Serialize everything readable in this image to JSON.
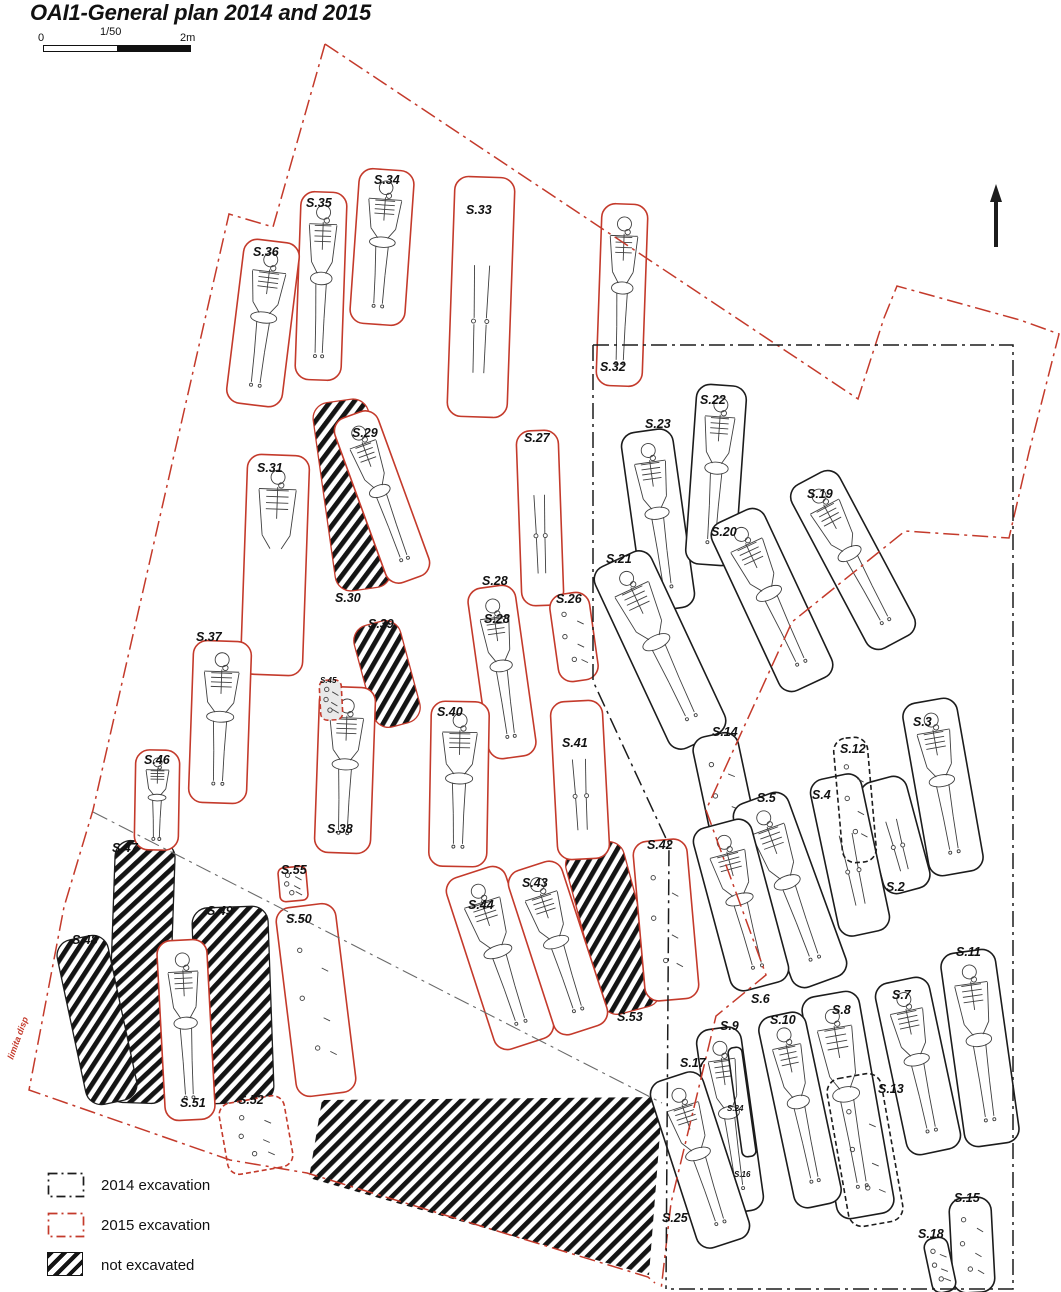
{
  "title": "OAI1-General plan 2014 and 2015",
  "scale_bar": {
    "left_label": "0",
    "mid_label": "1/50",
    "right_label": "2m"
  },
  "north_arrow": {
    "x": 996,
    "y_top": 184,
    "y_bottom": 247
  },
  "boundary_note": {
    "text": "limita disp",
    "x": 13,
    "y": 1060,
    "angle": -70
  },
  "colors": {
    "red": "#c43a2b",
    "black": "#1c1c1c",
    "gray": "#6a6a6a",
    "bone": "#3f3f3f",
    "label": "#111111"
  },
  "legend": [
    {
      "key": "excavation-2014",
      "label": "2014 excavation",
      "style": "dashdot",
      "color": "#1c1c1c"
    },
    {
      "key": "excavation-2015",
      "label": "2015 excavation",
      "style": "dashdot",
      "color": "#c43a2b"
    },
    {
      "key": "not-excavated",
      "label": "not excavated",
      "style": "hatch",
      "color": "#141414"
    }
  ],
  "hatched_areas": [
    {
      "id": "s30",
      "label": "S.30",
      "type": "rect",
      "x": 352,
      "y": 495,
      "w": 56,
      "h": 190,
      "a": -8,
      "outline": "red",
      "lx": 335,
      "ly": 591
    },
    {
      "id": "s39",
      "label": "S.39",
      "type": "rect",
      "x": 387,
      "y": 674,
      "w": 48,
      "h": 105,
      "a": -15,
      "outline": "red",
      "lx": 368,
      "ly": 617
    },
    {
      "id": "s47",
      "label": "S.47",
      "type": "rect",
      "x": 141,
      "y": 972,
      "w": 60,
      "h": 262,
      "a": 2,
      "outline": "black",
      "lx": 112,
      "ly": 841
    },
    {
      "id": "s48",
      "label": "S.48",
      "type": "rect",
      "x": 97,
      "y": 1020,
      "w": 52,
      "h": 168,
      "a": -12,
      "outline": "black",
      "lx": 72,
      "ly": 933
    },
    {
      "id": "s49",
      "label": "S.49",
      "type": "rect",
      "x": 233,
      "y": 1005,
      "w": 76,
      "h": 196,
      "a": -2,
      "outline": "black",
      "lx": 207,
      "ly": 904
    },
    {
      "id": "s53",
      "label": "S.53",
      "type": "rect",
      "x": 613,
      "y": 928,
      "w": 60,
      "h": 170,
      "a": -15,
      "outline": "red",
      "lx": 617,
      "ly": 1010
    },
    {
      "id": "south-area",
      "label": "",
      "type": "poly",
      "pts": [
        [
          322,
          1100
        ],
        [
          658,
          1097
        ],
        [
          661,
          1120
        ],
        [
          649,
          1275
        ],
        [
          309,
          1178
        ]
      ],
      "outline": "none",
      "lx": 0,
      "ly": 0
    }
  ],
  "graves": [
    {
      "id": "s33",
      "label": "S.33",
      "x": 481,
      "y": 297,
      "w": 60,
      "h": 240,
      "a": 2,
      "year": "2015",
      "content": "legs",
      "lx": 466,
      "ly": 203
    },
    {
      "id": "s34",
      "label": "S.34",
      "x": 382,
      "y": 247,
      "w": 55,
      "h": 155,
      "a": 4,
      "year": "2015",
      "content": "full",
      "lx": 374,
      "ly": 173
    },
    {
      "id": "s35",
      "label": "S.35",
      "x": 321,
      "y": 286,
      "w": 46,
      "h": 188,
      "a": 2,
      "year": "2015",
      "content": "full",
      "lx": 306,
      "ly": 196
    },
    {
      "id": "s36",
      "label": "S.36",
      "x": 263,
      "y": 323,
      "w": 56,
      "h": 165,
      "a": 7,
      "year": "2015",
      "content": "full",
      "lx": 253,
      "ly": 245
    },
    {
      "id": "s32",
      "label": "S.32",
      "x": 622,
      "y": 295,
      "w": 46,
      "h": 182,
      "a": 2,
      "year": "2015",
      "content": "full",
      "lx": 600,
      "ly": 360
    },
    {
      "id": "s31",
      "label": "S.31",
      "x": 275,
      "y": 565,
      "w": 62,
      "h": 220,
      "a": 2,
      "year": "2015",
      "content": "torso",
      "lx": 257,
      "ly": 461
    },
    {
      "id": "s29",
      "label": "S.29",
      "x": 382,
      "y": 497,
      "w": 46,
      "h": 175,
      "a": -20,
      "year": "2015",
      "content": "full",
      "lx": 352,
      "ly": 426
    },
    {
      "id": "s27",
      "label": "S.27",
      "x": 540,
      "y": 518,
      "w": 42,
      "h": 175,
      "a": -2,
      "year": "2015",
      "content": "legs",
      "lx": 524,
      "ly": 431
    },
    {
      "id": "s28",
      "label": "S.28",
      "x": 502,
      "y": 672,
      "w": 48,
      "h": 172,
      "a": -8,
      "year": "2015",
      "content": "full",
      "lx": 482,
      "ly": 574
    },
    {
      "id": "s26",
      "label": "S.26",
      "x": 574,
      "y": 637,
      "w": 40,
      "h": 88,
      "a": -8,
      "year": "2015",
      "content": "scatter",
      "lx": 556,
      "ly": 592
    },
    {
      "id": "s37",
      "label": "S.37",
      "x": 220,
      "y": 722,
      "w": 58,
      "h": 162,
      "a": 2,
      "year": "2015",
      "content": "full",
      "lx": 196,
      "ly": 630
    },
    {
      "id": "s38",
      "label": "S.38",
      "x": 345,
      "y": 770,
      "w": 56,
      "h": 166,
      "a": 2,
      "year": "2015",
      "content": "full",
      "lx": 327,
      "ly": 822
    },
    {
      "id": "s45",
      "label": "S.45",
      "x": 331,
      "y": 700,
      "w": 22,
      "h": 40,
      "a": -3,
      "year": "2015",
      "content": "scatter",
      "lx": 320,
      "ly": 676,
      "small": true,
      "dash": true,
      "fill": "#e9e9e9"
    },
    {
      "id": "s40",
      "label": "S.40",
      "x": 459,
      "y": 784,
      "w": 58,
      "h": 165,
      "a": 1,
      "year": "2015",
      "content": "full",
      "lx": 437,
      "ly": 705
    },
    {
      "id": "s41",
      "label": "S.41",
      "x": 580,
      "y": 780,
      "w": 52,
      "h": 158,
      "a": -3,
      "year": "2015",
      "content": "legs",
      "lx": 562,
      "ly": 736
    },
    {
      "id": "s46",
      "label": "S.46",
      "x": 157,
      "y": 800,
      "w": 44,
      "h": 100,
      "a": 1,
      "year": "2015",
      "content": "full",
      "lx": 144,
      "ly": 753
    },
    {
      "id": "s50",
      "label": "S.50",
      "x": 316,
      "y": 1000,
      "w": 60,
      "h": 190,
      "a": -7,
      "year": "2015",
      "content": "scatter",
      "lx": 286,
      "ly": 912
    },
    {
      "id": "s55",
      "label": "S.55",
      "x": 293,
      "y": 884,
      "w": 28,
      "h": 34,
      "a": -5,
      "year": "2015",
      "content": "scatter",
      "lx": 281,
      "ly": 863
    },
    {
      "id": "s51",
      "label": "S.51",
      "x": 186,
      "y": 1030,
      "w": 50,
      "h": 180,
      "a": -3,
      "year": "2015",
      "content": "full",
      "lx": 180,
      "ly": 1096
    },
    {
      "id": "s52",
      "label": "S.52",
      "x": 256,
      "y": 1135,
      "w": 66,
      "h": 72,
      "a": -10,
      "year": "2015",
      "content": "scatter",
      "lx": 238,
      "ly": 1093,
      "dash": true
    },
    {
      "id": "s44",
      "label": "S.44",
      "x": 500,
      "y": 958,
      "w": 62,
      "h": 180,
      "a": -18,
      "year": "2015",
      "content": "full",
      "lx": 468,
      "ly": 898
    },
    {
      "id": "s43",
      "label": "S.43",
      "x": 558,
      "y": 948,
      "w": 56,
      "h": 172,
      "a": -18,
      "year": "2015",
      "content": "full",
      "lx": 522,
      "ly": 876
    },
    {
      "id": "s42",
      "label": "S.42",
      "x": 666,
      "y": 920,
      "w": 54,
      "h": 160,
      "a": -5,
      "year": "2015",
      "content": "scatter",
      "lx": 647,
      "ly": 838
    },
    {
      "id": "s23",
      "label": "S.23",
      "x": 658,
      "y": 520,
      "w": 52,
      "h": 180,
      "a": -8,
      "year": "2014",
      "content": "full",
      "lx": 645,
      "ly": 417
    },
    {
      "id": "s22",
      "label": "S.22",
      "x": 716,
      "y": 475,
      "w": 50,
      "h": 180,
      "a": 4,
      "year": "2014",
      "content": "full",
      "lx": 700,
      "ly": 393
    },
    {
      "id": "s21",
      "label": "S.21",
      "x": 660,
      "y": 650,
      "w": 62,
      "h": 200,
      "a": -25,
      "year": "2014",
      "content": "full",
      "lx": 606,
      "ly": 552
    },
    {
      "id": "s20",
      "label": "S.20",
      "x": 772,
      "y": 600,
      "w": 58,
      "h": 185,
      "a": -25,
      "year": "2014",
      "content": "full",
      "lx": 711,
      "ly": 525
    },
    {
      "id": "s19",
      "label": "S.19",
      "x": 853,
      "y": 560,
      "w": 54,
      "h": 185,
      "a": -28,
      "year": "2014",
      "content": "full",
      "lx": 807,
      "ly": 487
    },
    {
      "id": "s14",
      "label": "S.14",
      "x": 726,
      "y": 796,
      "w": 46,
      "h": 125,
      "a": -12,
      "year": "2014",
      "content": "scatter",
      "lx": 712,
      "ly": 725
    },
    {
      "id": "s3",
      "label": "S.3",
      "x": 943,
      "y": 787,
      "w": 55,
      "h": 175,
      "a": -10,
      "year": "2014",
      "content": "full",
      "lx": 913,
      "ly": 715
    },
    {
      "id": "s2",
      "label": "S.2",
      "x": 895,
      "y": 835,
      "w": 48,
      "h": 115,
      "a": -15,
      "year": "2014",
      "content": "legs",
      "lx": 886,
      "ly": 880
    },
    {
      "id": "s4",
      "label": "S.4",
      "x": 850,
      "y": 855,
      "w": 52,
      "h": 160,
      "a": -12,
      "year": "2014",
      "content": "legs",
      "lx": 812,
      "ly": 788
    },
    {
      "id": "s12",
      "label": "S.12",
      "x": 855,
      "y": 800,
      "w": 34,
      "h": 125,
      "a": -5,
      "year": "2014",
      "content": "scatter",
      "lx": 840,
      "ly": 742,
      "dash": true,
      "fill": "none"
    },
    {
      "id": "s5",
      "label": "S.5",
      "x": 790,
      "y": 890,
      "w": 58,
      "h": 195,
      "a": -20,
      "year": "2014",
      "content": "full",
      "lx": 757,
      "ly": 791
    },
    {
      "id": "s6",
      "label": "S.6",
      "x": 741,
      "y": 905,
      "w": 60,
      "h": 168,
      "a": -15,
      "year": "2014",
      "content": "full",
      "lx": 751,
      "ly": 992
    },
    {
      "id": "s11",
      "label": "S.11",
      "x": 980,
      "y": 1048,
      "w": 55,
      "h": 195,
      "a": -8,
      "year": "2014",
      "content": "full",
      "lx": 956,
      "ly": 945
    },
    {
      "id": "s7",
      "label": "S.7",
      "x": 918,
      "y": 1066,
      "w": 55,
      "h": 175,
      "a": -12,
      "year": "2014",
      "content": "full",
      "lx": 892,
      "ly": 988
    },
    {
      "id": "s8",
      "label": "S.8",
      "x": 848,
      "y": 1105,
      "w": 58,
      "h": 225,
      "a": -10,
      "year": "2014",
      "content": "full",
      "lx": 832,
      "ly": 1003
    },
    {
      "id": "s13",
      "label": "S.13",
      "x": 865,
      "y": 1150,
      "w": 55,
      "h": 150,
      "a": -10,
      "year": "2014",
      "content": "scatter",
      "lx": 878,
      "ly": 1082,
      "dash": true,
      "fill": "none"
    },
    {
      "id": "s10",
      "label": "S.10",
      "x": 800,
      "y": 1110,
      "w": 48,
      "h": 195,
      "a": -12,
      "year": "2014",
      "content": "full",
      "lx": 770,
      "ly": 1013
    },
    {
      "id": "s9",
      "label": "S.9",
      "x": 730,
      "y": 1120,
      "w": 45,
      "h": 185,
      "a": -8,
      "year": "2014",
      "content": "full",
      "lx": 720,
      "ly": 1019
    },
    {
      "id": "s24",
      "label": "S.24",
      "x": 742,
      "y": 1102,
      "w": 14,
      "h": 110,
      "a": -8,
      "year": "2014",
      "content": "none",
      "lx": 727,
      "ly": 1104,
      "small": true,
      "fill": "none"
    },
    {
      "id": "s17",
      "label": "S.17",
      "x": 700,
      "y": 1160,
      "w": 55,
      "h": 175,
      "a": -18,
      "year": "2014",
      "content": "full",
      "lx": 680,
      "ly": 1056
    },
    {
      "id": "s25",
      "label": "S.25",
      "x": 0,
      "y": 0,
      "w": 0,
      "h": 0,
      "a": 0,
      "year": "2014",
      "content": "none",
      "lx": 662,
      "ly": 1211
    },
    {
      "id": "s16",
      "label": "S.16",
      "x": 0,
      "y": 0,
      "w": 0,
      "h": 0,
      "a": 0,
      "year": "2014",
      "content": "none",
      "lx": 734,
      "ly": 1170,
      "small": true
    },
    {
      "id": "s15",
      "label": "S.15",
      "x": 972,
      "y": 1245,
      "w": 42,
      "h": 95,
      "a": -3,
      "year": "2014",
      "content": "scatter",
      "lx": 954,
      "ly": 1191
    },
    {
      "id": "s18",
      "label": "S.18",
      "x": 940,
      "y": 1265,
      "w": 24,
      "h": 55,
      "a": -12,
      "year": "2014",
      "content": "scatter",
      "lx": 918,
      "ly": 1227
    }
  ],
  "extra_labels": [
    {
      "text": "S.28",
      "x": 484,
      "y": 612
    }
  ],
  "boundaries": [
    {
      "id": "limit-2015-east",
      "color": "red",
      "pts": [
        [
          325,
          44
        ],
        [
          858,
          399
        ],
        [
          884,
          318
        ],
        [
          897,
          286
        ],
        [
          1020,
          320
        ],
        [
          1059,
          334
        ],
        [
          1029,
          452
        ],
        [
          1009,
          538
        ],
        [
          905,
          531
        ],
        [
          792,
          622
        ],
        [
          706,
          810
        ],
        [
          766,
          975
        ],
        [
          716,
          1016
        ],
        [
          671,
          1203
        ],
        [
          661,
          1290
        ]
      ]
    },
    {
      "id": "limit-2015-west",
      "color": "red",
      "pts": [
        [
          325,
          44
        ],
        [
          273,
          227
        ],
        [
          229,
          214
        ],
        [
          93,
          810
        ],
        [
          64,
          907
        ],
        [
          29,
          1090
        ],
        [
          230,
          1160
        ],
        [
          307,
          1173
        ],
        [
          648,
          1277
        ],
        [
          655,
          1283
        ]
      ]
    },
    {
      "id": "limit-2014-outline",
      "color": "black",
      "pts": [
        [
          593,
          345
        ],
        [
          1013,
          345
        ],
        [
          1013,
          1289
        ],
        [
          666,
          1289
        ]
      ]
    },
    {
      "id": "limit-2014-west",
      "color": "black",
      "pts": [
        [
          593,
          345
        ],
        [
          593,
          681
        ],
        [
          669,
          845
        ],
        [
          666,
          1289
        ]
      ]
    },
    {
      "id": "trench-diagonal",
      "color": "gray",
      "pts": [
        [
          93,
          812
        ],
        [
          662,
          1103
        ]
      ]
    }
  ]
}
